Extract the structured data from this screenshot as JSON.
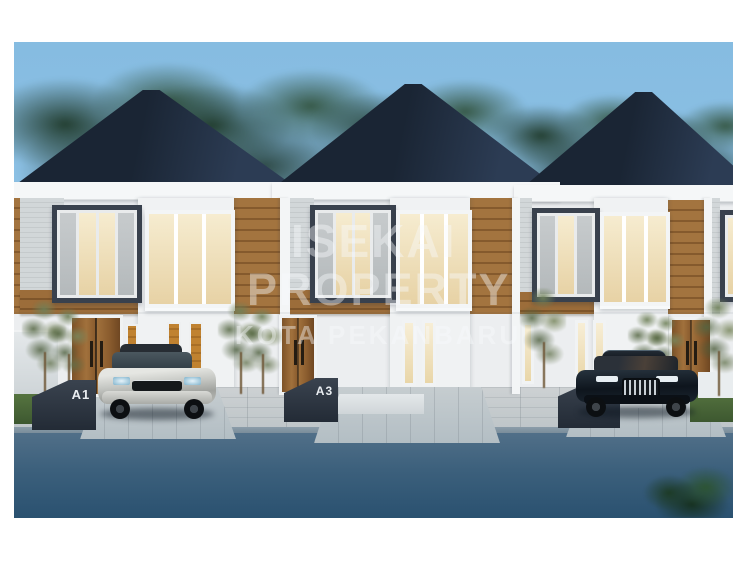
{
  "scene": {
    "description": "3D architectural rendering of a row of modern two-storey townhouses at dusk, framed by a white border",
    "watermark": {
      "line1": "ISEKAI",
      "line2": "PROPERTY",
      "line3": "KOTA PEKANBARU"
    },
    "units": [
      {
        "label": "A1"
      },
      {
        "label": "A3"
      },
      {
        "label": "A5"
      }
    ],
    "vehicles": [
      {
        "name": "silver-suv",
        "color": "#c4c6c2"
      },
      {
        "name": "dark-sedan",
        "color": "#0e151d"
      }
    ],
    "colors": {
      "sky": "#8dc1e3",
      "roof": "#1e2b3e",
      "wood_panel": "#a3743f",
      "wall_white": "#eff1f2",
      "stone": "#ccd1d3",
      "lit_window": "#f3e5c1",
      "accent_window": "#c08230",
      "pavement": "#c8cdd0",
      "road": "#35597a",
      "sign": "#2e3744",
      "foliage": "#2a4a34",
      "watermark": "#f8fafc"
    }
  }
}
